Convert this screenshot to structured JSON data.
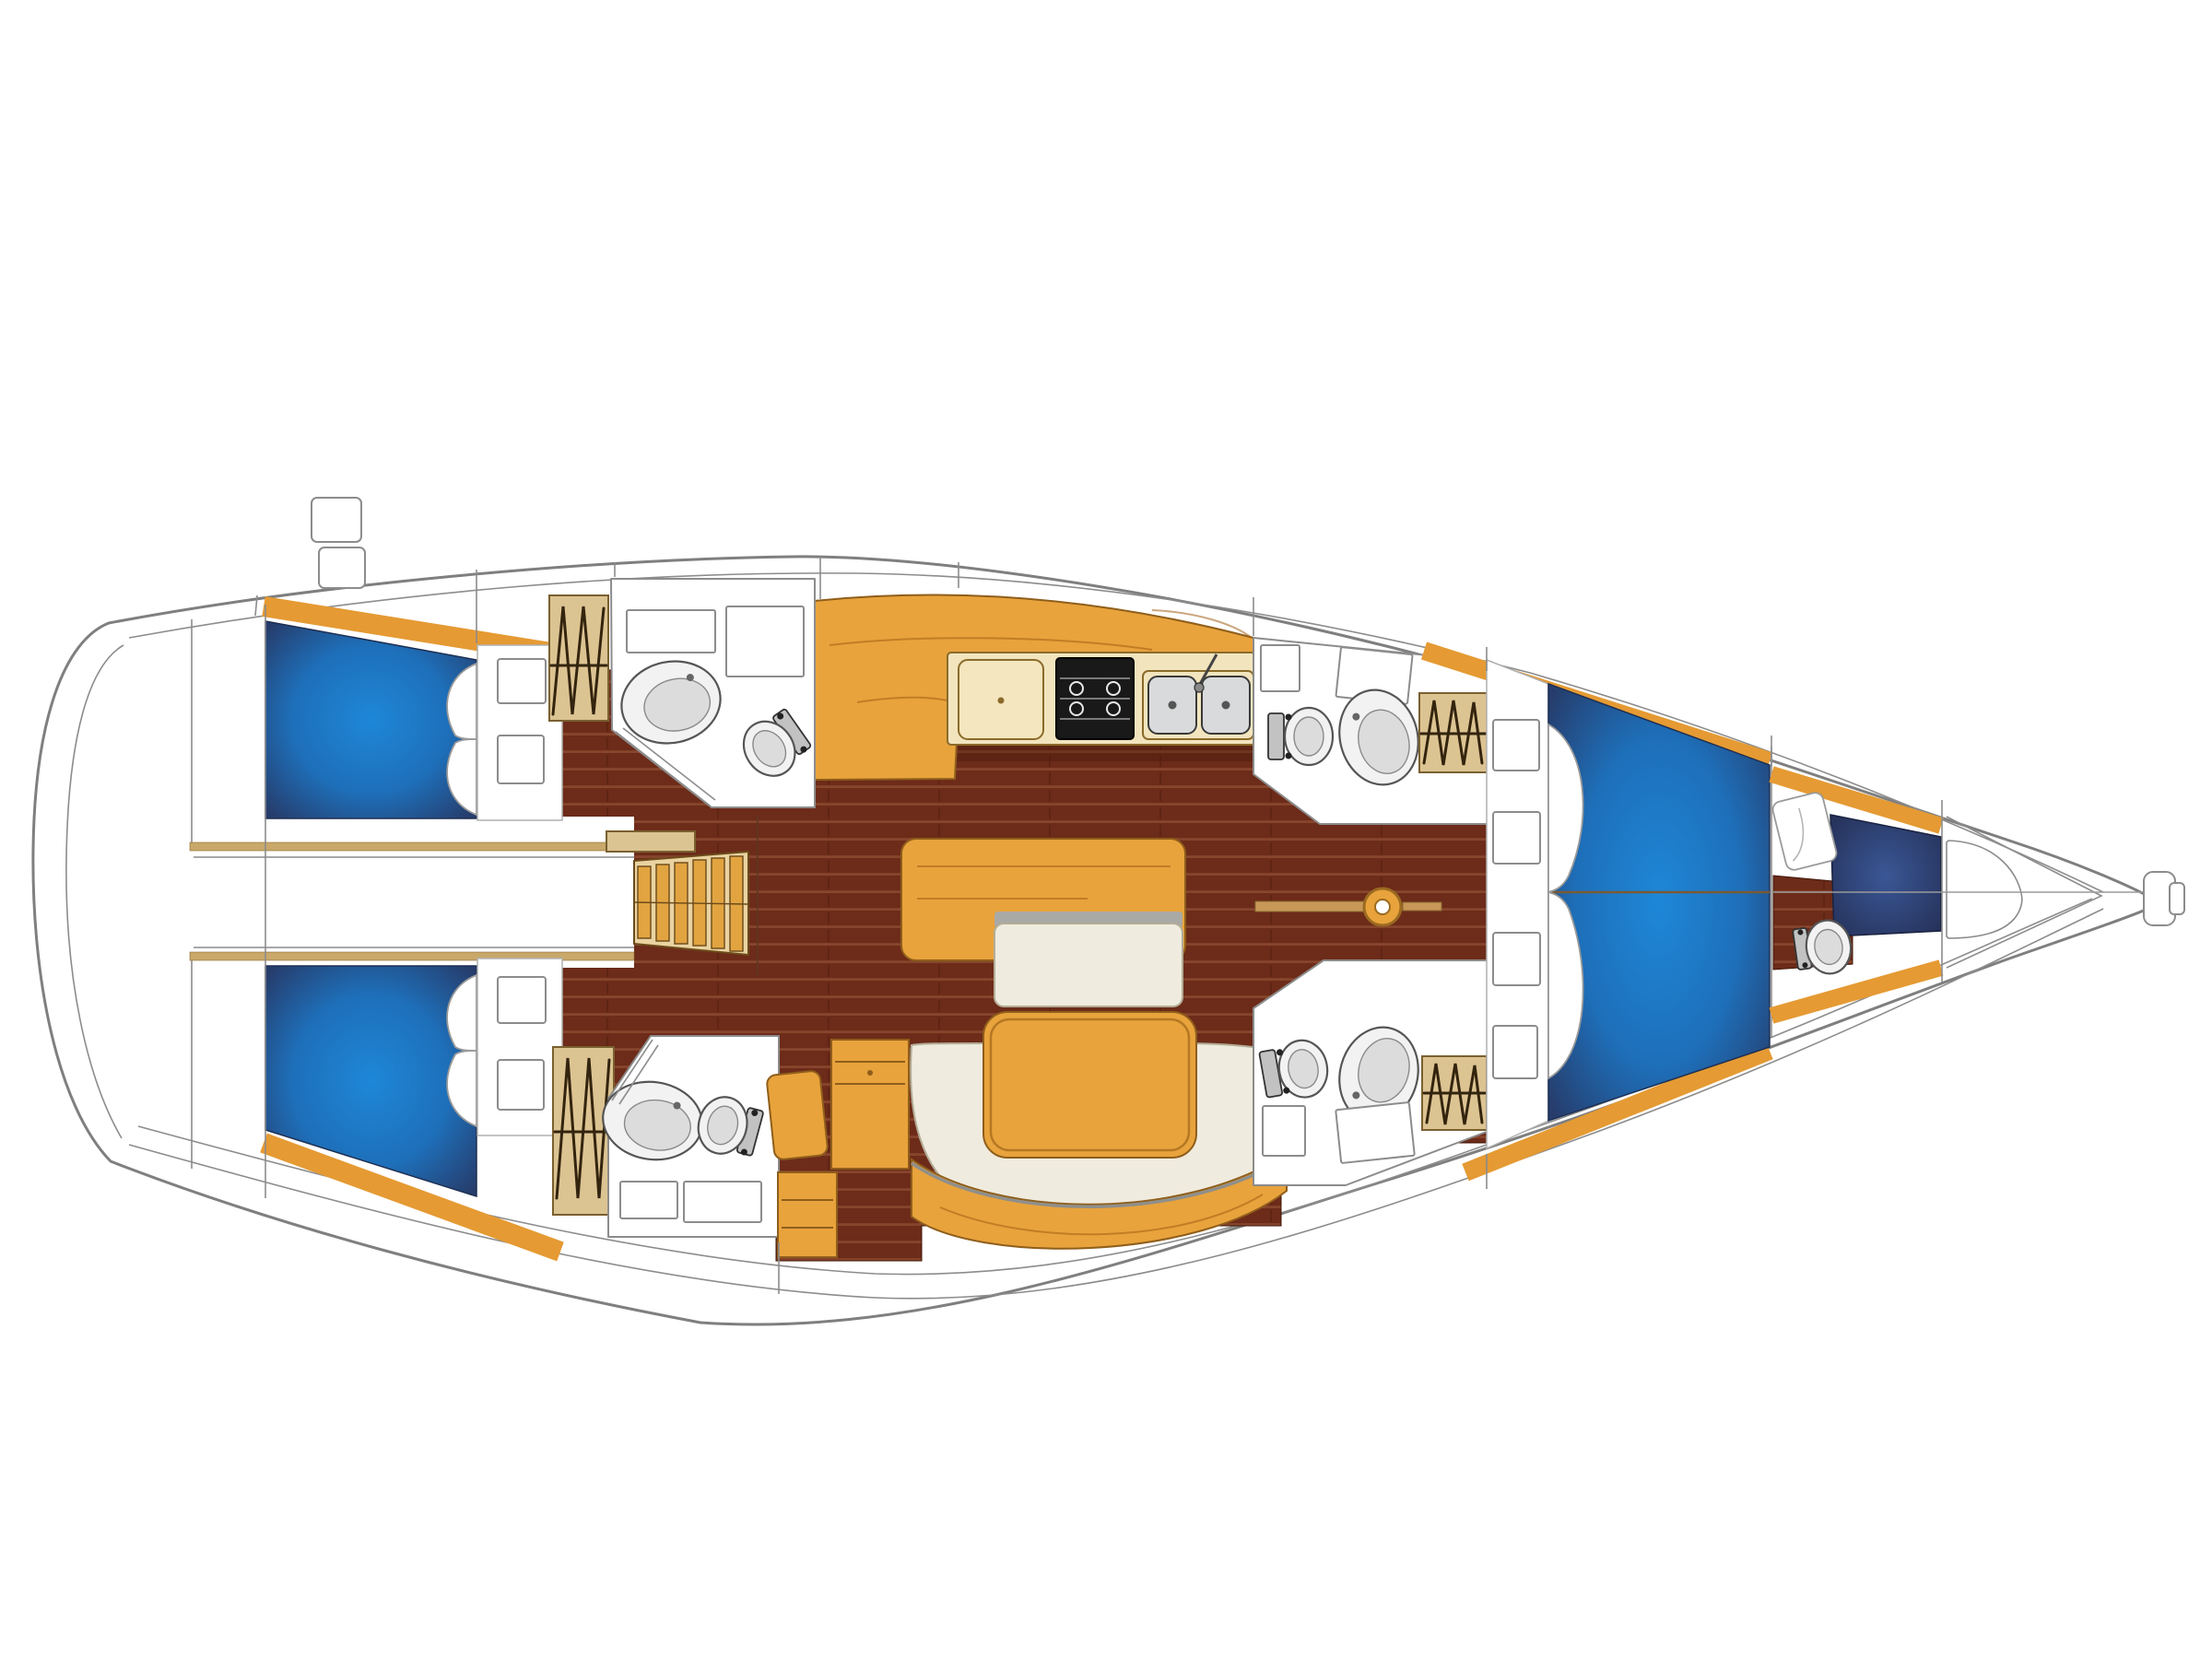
{
  "page": {
    "type": "boat-interior-floorplan",
    "subject": "sailing yacht accommodation layout, plan view, bow pointing right",
    "text_labels": []
  },
  "colors": {
    "hullLine": "#7f7f7f",
    "line": "#8c8c8c",
    "wood": "#e8a33c",
    "trim": "#e59a33",
    "woodEdge": "#8f5e1b",
    "floor": "#6d2b19",
    "floorLine": "#86452c",
    "bedCenter": "#1e87d8",
    "bedMid": "#1e6fb9",
    "bedEdge": "#263c6b",
    "navyCenter": "#3a5796",
    "navyEdge": "#232d52",
    "cream": "#efebde",
    "creamEdge": "#b3ac96",
    "tan": "#dcc392",
    "tanEdge": "#7a6030",
    "hatch": "#33240e",
    "steel": "#d8dadb",
    "fixture": "#f2f2f2",
    "fixtureInner": "#dcdcdc",
    "fixtureEdge": "#555555",
    "grayBand": "#a9a9a5",
    "creamPanel": "#f2e5be",
    "panelEdge": "#8a6a2a",
    "wall": "#c9a86a",
    "stepBg": "#ead3a0",
    "stepSlat": "#e2a440",
    "stepEdge": "#6b4a1a",
    "shadow": "rgba(61,20,8,0.30)"
  },
  "areas": [
    {
      "name": "stern-transom"
    },
    {
      "name": "aft-cabin-port"
    },
    {
      "name": "aft-cabin-starboard"
    },
    {
      "name": "engine-corridor"
    },
    {
      "name": "companionway-steps"
    },
    {
      "name": "head-aft-port"
    },
    {
      "name": "head-aft-starboard"
    },
    {
      "name": "galley"
    },
    {
      "name": "saloon"
    },
    {
      "name": "nav-station"
    },
    {
      "name": "head-mid-port"
    },
    {
      "name": "head-mid-starboard"
    },
    {
      "name": "forward-cabin"
    },
    {
      "name": "forepeak-cabin"
    },
    {
      "name": "anchor-locker"
    },
    {
      "name": "bow"
    }
  ],
  "fixtures": [
    "double-berth",
    "pillow",
    "hanging-locker",
    "locker-hatch",
    "toilet",
    "washbasin",
    "fridge",
    "stove",
    "double-sink",
    "salon-table",
    "settee",
    "sideboard",
    "bench",
    "nav-desk",
    "nav-seat",
    "drawer-unit",
    "mast-step",
    "keel-beam",
    "bow-roller",
    "deck-hatch"
  ]
}
